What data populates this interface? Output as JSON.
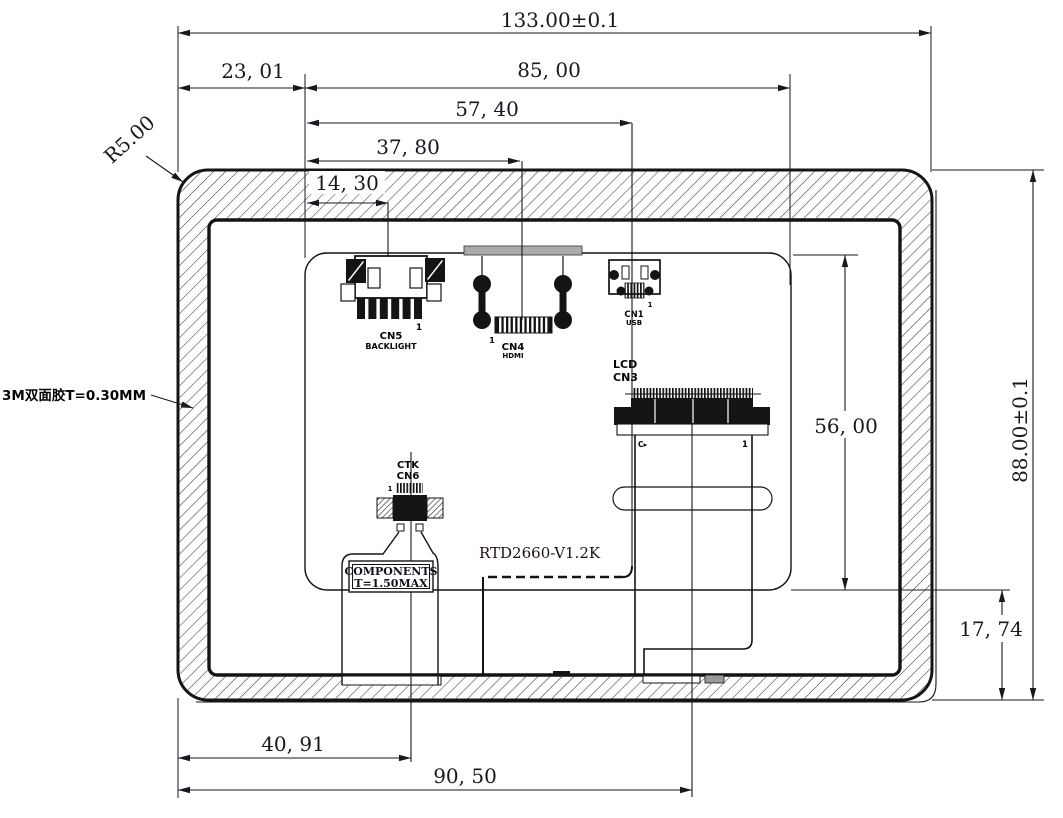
{
  "dims": {
    "overall_width": "133.00±0.1",
    "left_edge_to_pcb": "23, 01",
    "pcb_width": "85, 00",
    "usb_center": "57, 40",
    "hdmi_center": "37, 80",
    "backlight_center": "14, 30",
    "ctk_center": "40, 91",
    "lcd_center": "90, 50",
    "pcb_height": "56, 00",
    "pcb_to_bottom_edge": "17, 74",
    "overall_height": "88.00±0.1",
    "corner_radius": "R5.00"
  },
  "notes": {
    "adhesive": "3M双面胶T=0.30MM",
    "board_model": "RTD2660-V1.2K",
    "components_line1": "COMPONENTS",
    "components_line2": "T=1.50MAX"
  },
  "connectors": {
    "cn5": {
      "name": "CN5",
      "type": "BACKLIGHT",
      "pin1": "1"
    },
    "cn4": {
      "name": "CN4",
      "type": "HDMI",
      "pin1": "1"
    },
    "cn1": {
      "name": "CN1",
      "type": "USB",
      "pin1": "1"
    },
    "cn3": {
      "line1": "LCD",
      "line2": "CN3",
      "mark_left": "C▸",
      "mark_right": "1"
    },
    "cn6": {
      "line1": "CTK",
      "line2": "CN6",
      "pin1": "1"
    }
  }
}
